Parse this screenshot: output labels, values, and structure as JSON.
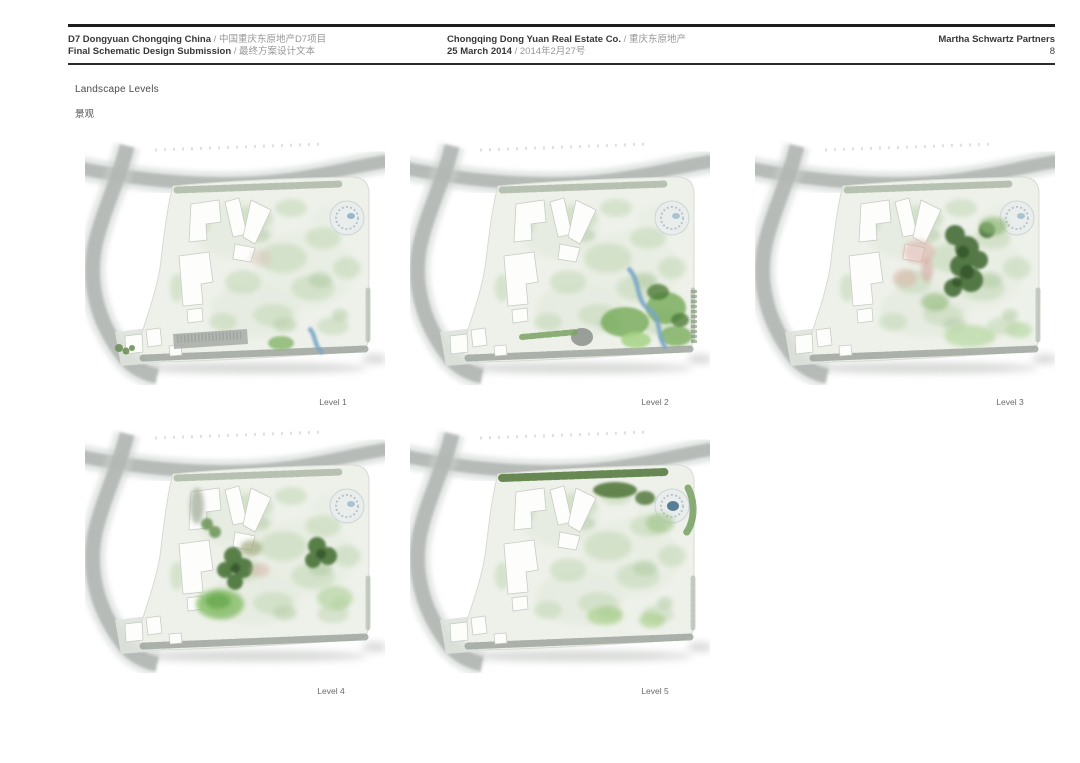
{
  "header": {
    "separator": " / ",
    "line1_left_en": "D7 Dongyuan Chongqing China",
    "line1_left_zh": "中国重庆东原地产D7项目",
    "line2_left_en": "Final Schematic Design Submission",
    "line2_left_zh": "最终方案设计文本",
    "line1_center_en": "Chongqing Dong Yuan Real Estate Co.",
    "line1_center_zh": "重庆东原地产",
    "line2_center_en": "25 March 2014",
    "line2_center_zh": "2014年2月27号",
    "firm": "Martha Schwartz Partners",
    "page_number": "8"
  },
  "section": {
    "title": "Landscape Levels",
    "title_zh": "景观"
  },
  "figures": [
    {
      "id": "level-1",
      "label": "Level 1"
    },
    {
      "id": "level-2",
      "label": "Level 2"
    },
    {
      "id": "level-3",
      "label": "Level 3"
    },
    {
      "id": "level-4",
      "label": "Level 4"
    },
    {
      "id": "level-5",
      "label": "Level 5"
    }
  ],
  "colors": {
    "rule_black": "#1c1c1c",
    "road_gray": "#b2b7b4",
    "parcel_fill": "#eef1ea",
    "pale_green": "#c8dbbd",
    "medium_green": "#7bae5f",
    "dark_green": "#49703a",
    "lawn_green": "#8ac06d",
    "water_blue": "#7ca7c7",
    "pink_accent": "#d9ada3",
    "label_gray": "#6a6a6a"
  }
}
